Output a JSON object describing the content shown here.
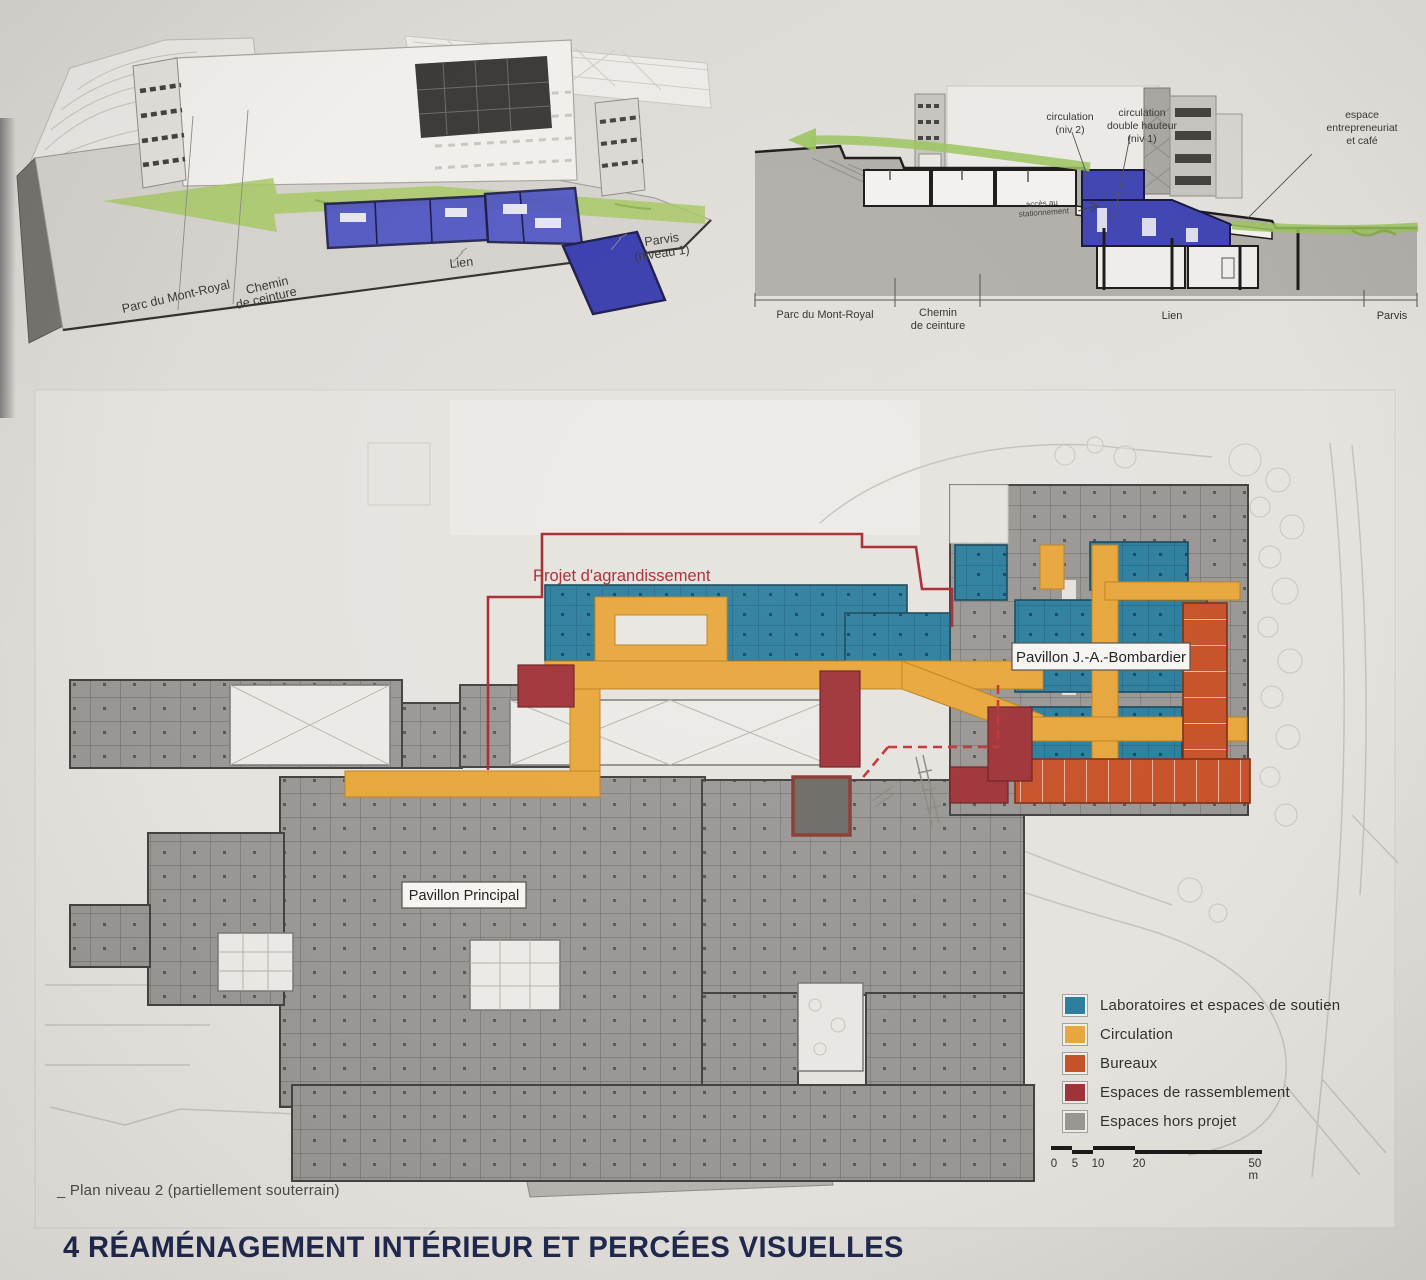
{
  "colors": {
    "labs_teal": "#2e7f9e",
    "circulation_orange": "#e8a73e",
    "bureaux_orange": "#c8532a",
    "rassemblement_red": "#a0353a",
    "hors_projet_gray": "#9b9894",
    "project_boundary_red": "#a92b32",
    "link_blue": "#4347b8",
    "greenway_green": "#9cc45e",
    "title_navy": "#20294f"
  },
  "axon": {
    "labels": {
      "parc": "Parc du Mont-Royal",
      "chemin_1": "Chemin",
      "chemin_2": "de ceinture",
      "lien": "Lien",
      "parvis_1": "Parvis",
      "parvis_2": "(niveau 1)"
    }
  },
  "section": {
    "annotations": {
      "circ2_1": "circulation",
      "circ2_2": "(niv 2)",
      "circ1_1": "circulation",
      "circ1_2": "double hauteur",
      "circ1_3": "(niv 1)",
      "espace_1": "espace",
      "espace_2": "entrepreneuriat",
      "espace_3": "et café",
      "acces_1": "accès au",
      "acces_2": "stationnement"
    },
    "axis": {
      "parc": "Parc du Mont-Royal",
      "chemin_1": "Chemin",
      "chemin_2": "de ceinture",
      "lien": "Lien",
      "parvis": "Parvis"
    }
  },
  "plan": {
    "labels": {
      "agrandissement": "Projet d'agrandissement",
      "bombardier": "Pavillon J.-A.-Bombardier",
      "principal": "Pavillon Principal"
    }
  },
  "legend": {
    "items": [
      {
        "label": "Laboratoires et espaces de soutien",
        "color": "#2e7f9e"
      },
      {
        "label": "Circulation",
        "color": "#e8a73e"
      },
      {
        "label": "Bureaux",
        "color": "#c8532a"
      },
      {
        "label": "Espaces de rassemblement",
        "color": "#a0353a"
      },
      {
        "label": "Espaces hors projet",
        "color": "#9b9894"
      }
    ]
  },
  "scalebar": {
    "ticks": [
      "0",
      "5",
      "10",
      "20",
      "50 m"
    ]
  },
  "caption": "_ Plan niveau 2 (partiellement souterrain)",
  "title": "4  RÉAMÉNAGEMENT INTÉRIEUR ET PERCÉES VISUELLES"
}
